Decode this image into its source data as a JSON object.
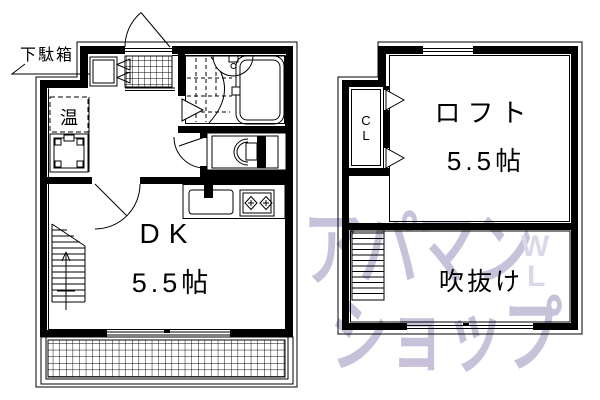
{
  "page": {
    "background": "#ffffff",
    "line_color": "#000000"
  },
  "floor1": {
    "shoe_cabinet_label": "下駄箱",
    "water_heater_label": "温",
    "room_label": "DK",
    "room_size": "5.5帖"
  },
  "floor2": {
    "closet_line1": "C",
    "closet_line2": "L",
    "room_label": "ロフト",
    "room_size": "5.5帖",
    "void_label": "吹抜け"
  },
  "watermark": {
    "line1": "アパマン",
    "line2": "ショップ",
    "mark_line1": "W",
    "mark_line2": "L",
    "color": "#c7c1da"
  }
}
